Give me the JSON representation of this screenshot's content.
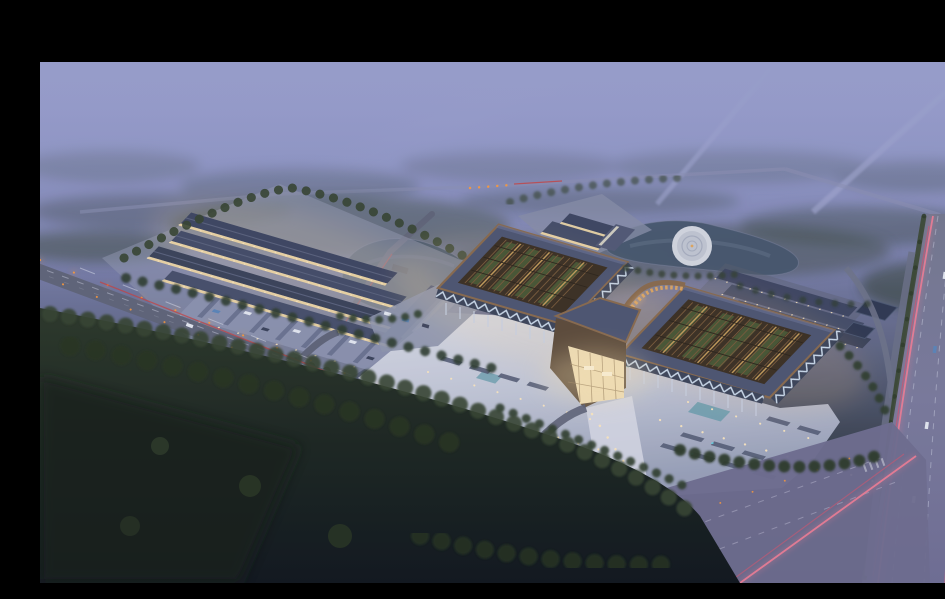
{
  "meta": {
    "type": "architectural-aerial-rendering",
    "time_of_day": "dusk",
    "description": "Dusk aerial rendering of a large Chinese-style exhibition and market complex: two pavilion halls with upturned copper-edged lattice roofs and glowing courtyards joined by a lit gateway, a bright plaza with parking rows, a western market building cluster with its own parking lot, two ponds with a circular island plaza, rows of outbuildings, a diagonal avenue with street lights and red car-light trails, a wide highway with pink light trails, hazy periwinkle fog above and dark forested fields in the foreground. No text is visible in the image."
  },
  "palette": {
    "letterbox": "#000000",
    "sky_top": "#9397c9",
    "sky_mid": "#7d82ad",
    "fog": "#9aa0cd",
    "dusk_ground": "#4e5570",
    "forest_dark": "#1a231d",
    "tree": "#35432f",
    "road": "#5f6377",
    "road_line": "#b9bdce",
    "highway": "#78799a",
    "junction": "#6e6c8e",
    "plaza": "#c9ccdb",
    "plaza_deep": "#9aa0b8",
    "pavement": "#8f96ad",
    "roof_dark": "#4d5470",
    "roof_slate": "#3d4460",
    "copper": "#8a6a4c",
    "lattice_dark": "#3b2e20",
    "slat": "#7a5a39",
    "slat_lit": "#caa05c",
    "amber": "#e2a75e",
    "courtyard_green": "#4b5c35",
    "truss_band": "#3c4358",
    "truss_zigzag": "#cfdded",
    "facade_warm": "#f1d8a3",
    "gate_glow": "#f4e0b4",
    "light_warm": "#ffe9c0",
    "light_orange": "#ff9a3a",
    "light_blue": "#62d4e6",
    "trail_red": "#c84040",
    "trail_pink": "#ee7d95",
    "water": "#46566c",
    "island": "#d5d8e1",
    "car_white": "#e6e9f2",
    "car_blue": "#5b84b8",
    "median_green": "#39462f"
  },
  "scene": {
    "regions": [
      {
        "name": "letterbox-top-bar"
      },
      {
        "name": "hazy-sky-and-fog"
      },
      {
        "name": "distant-roads-top-right"
      },
      {
        "name": "west-market-complex-with-parking"
      },
      {
        "name": "west-pond"
      },
      {
        "name": "visitor-center-cluster"
      },
      {
        "name": "northeast-pond-with-circular-island"
      },
      {
        "name": "pavilion-west-hall"
      },
      {
        "name": "pavilion-east-hall"
      },
      {
        "name": "central-gateway-hall"
      },
      {
        "name": "main-plaza-with-parking-rows"
      },
      {
        "name": "northeast-outbuilding-rows"
      },
      {
        "name": "southwest-avenue-with-light-trails"
      },
      {
        "name": "highway-with-pink-trails"
      },
      {
        "name": "road-junction-bottom-right"
      },
      {
        "name": "foreground-forest-and-fields"
      }
    ]
  }
}
